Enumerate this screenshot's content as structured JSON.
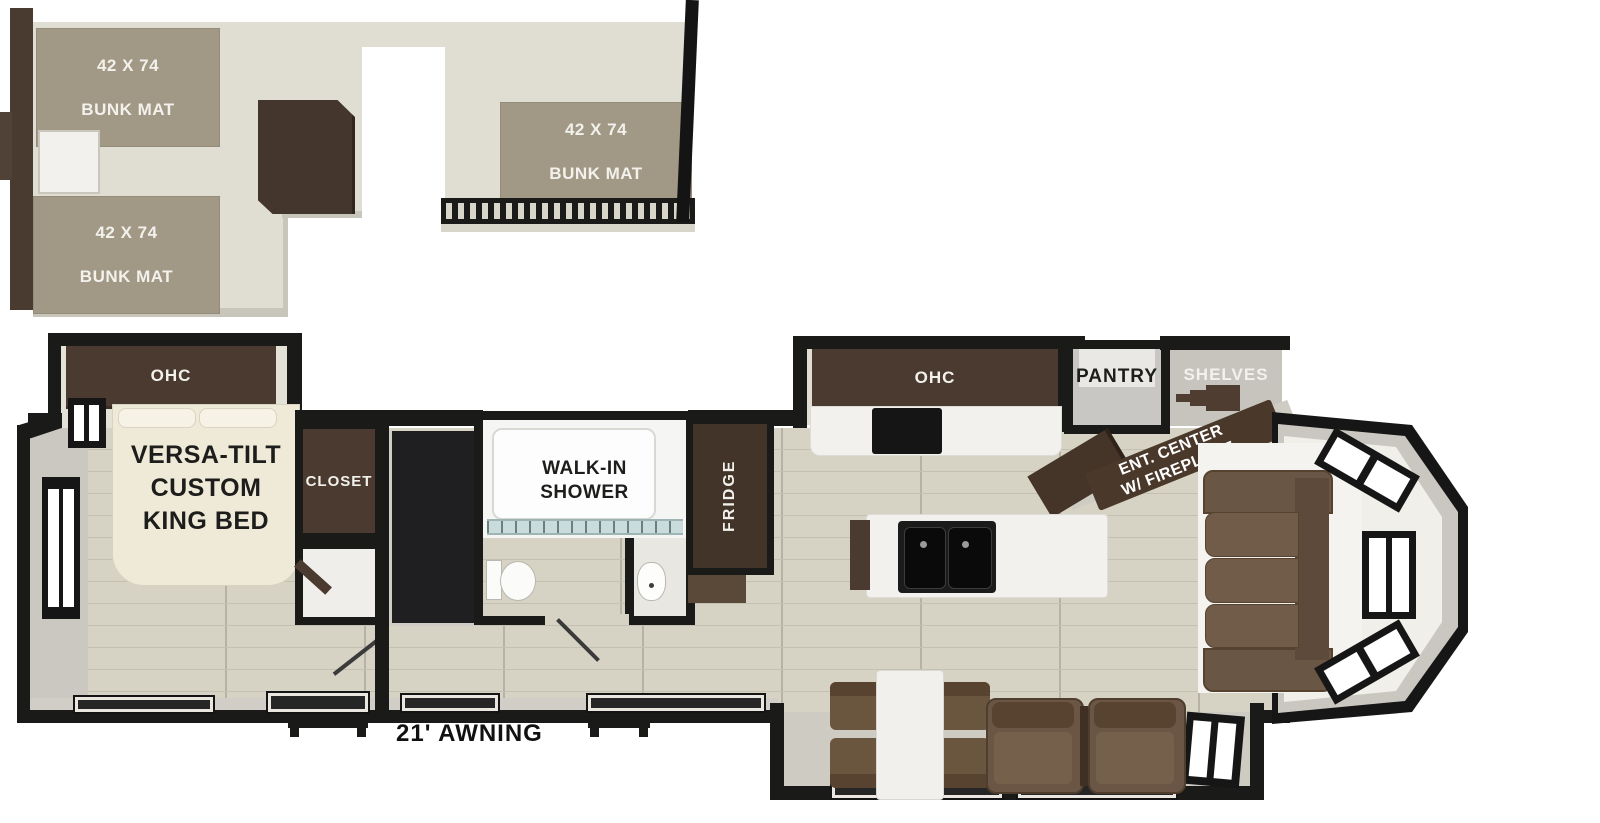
{
  "plan": {
    "loft": {
      "bunks": [
        {
          "line1": "42 X 74",
          "line2": "BUNK MAT"
        },
        {
          "line1": "42 X 74",
          "line2": "BUNK MAT"
        },
        {
          "line1": "42 X 74",
          "line2": "BUNK MAT"
        }
      ]
    },
    "bedroom": {
      "ohc": "OHC",
      "bed1": "VERSA-TILT",
      "bed2": "CUSTOM",
      "bed3": "KING BED",
      "closet": "CLOSET"
    },
    "bath": {
      "shower1": "WALK-IN",
      "shower2": "SHOWER"
    },
    "kitchen": {
      "fridge": "FRIDGE",
      "ohc": "OHC",
      "pantry": "PANTRY",
      "shelves": "SHELVES"
    },
    "living": {
      "ent1": "ENT. CENTER",
      "ent2": "W/ FIREPLACE"
    },
    "exterior": {
      "awning": "21' AWNING"
    },
    "colors": {
      "floor_wood": "#d6d2c4",
      "loft_floor": "#e0ddd2",
      "bunk_mat": "#a29886",
      "cabinet_dark_brown": "#4a3a2f",
      "wall_black": "#1a1a19",
      "wall_gray": "#cac8c0",
      "bed_cream": "#efe9d8",
      "sofa_brown": "#6b5645",
      "counter_white": "#f2f1ee",
      "sink_black": "#161616",
      "label_white": "#f2f1ec",
      "label_black": "#1d1d1b"
    }
  }
}
